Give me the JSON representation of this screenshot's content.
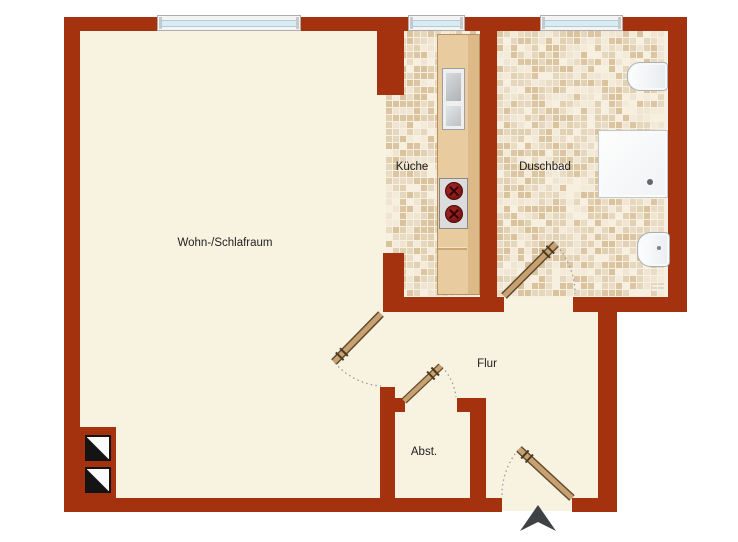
{
  "app": {
    "type": "apartment-floor-plan"
  },
  "rooms": {
    "wohn": {
      "label": "Wohn-/Schlafraum"
    },
    "kueche": {
      "label": "Küche"
    },
    "duschbad": {
      "label": "Duschbad"
    },
    "flur": {
      "label": "Flur"
    },
    "abst": {
      "label": "Abst."
    }
  },
  "fixtures": {
    "toilet": "toilet",
    "shower": "shower-tray",
    "washbasin": "washbasin",
    "kitchen_sink": "kitchen-sink",
    "stove": "stove-two-burners",
    "entrance_arrow": "entrance-arrow",
    "shaft_symbols": "installation-shaft",
    "windows": [
      "living-room-window",
      "kitchen-window",
      "bathroom-window"
    ],
    "doors": [
      "living-room-door",
      "bathroom-door",
      "storage-door",
      "entrance-door"
    ]
  },
  "colors": {
    "wall": "#A5320F",
    "floor": "#F8F2E0",
    "tile_bg": "#F7F0E1",
    "counter_wood": "#E9CBA0",
    "counter_wood_dark": "#DDB988",
    "door_leaf": "#C8A171",
    "door_leaf_outline": "#5F4A2E",
    "window_glass": "#D9ECF4",
    "arrow": "#3F4245",
    "burner": "#7E1212"
  },
  "tile_shades": [
    "#EADCC4",
    "#E2D0B2",
    "#DBC5A2",
    "#EFE5D2",
    "#E5D7BD",
    "#D9C29C",
    "#F3EADA",
    "#F7F0E1"
  ]
}
